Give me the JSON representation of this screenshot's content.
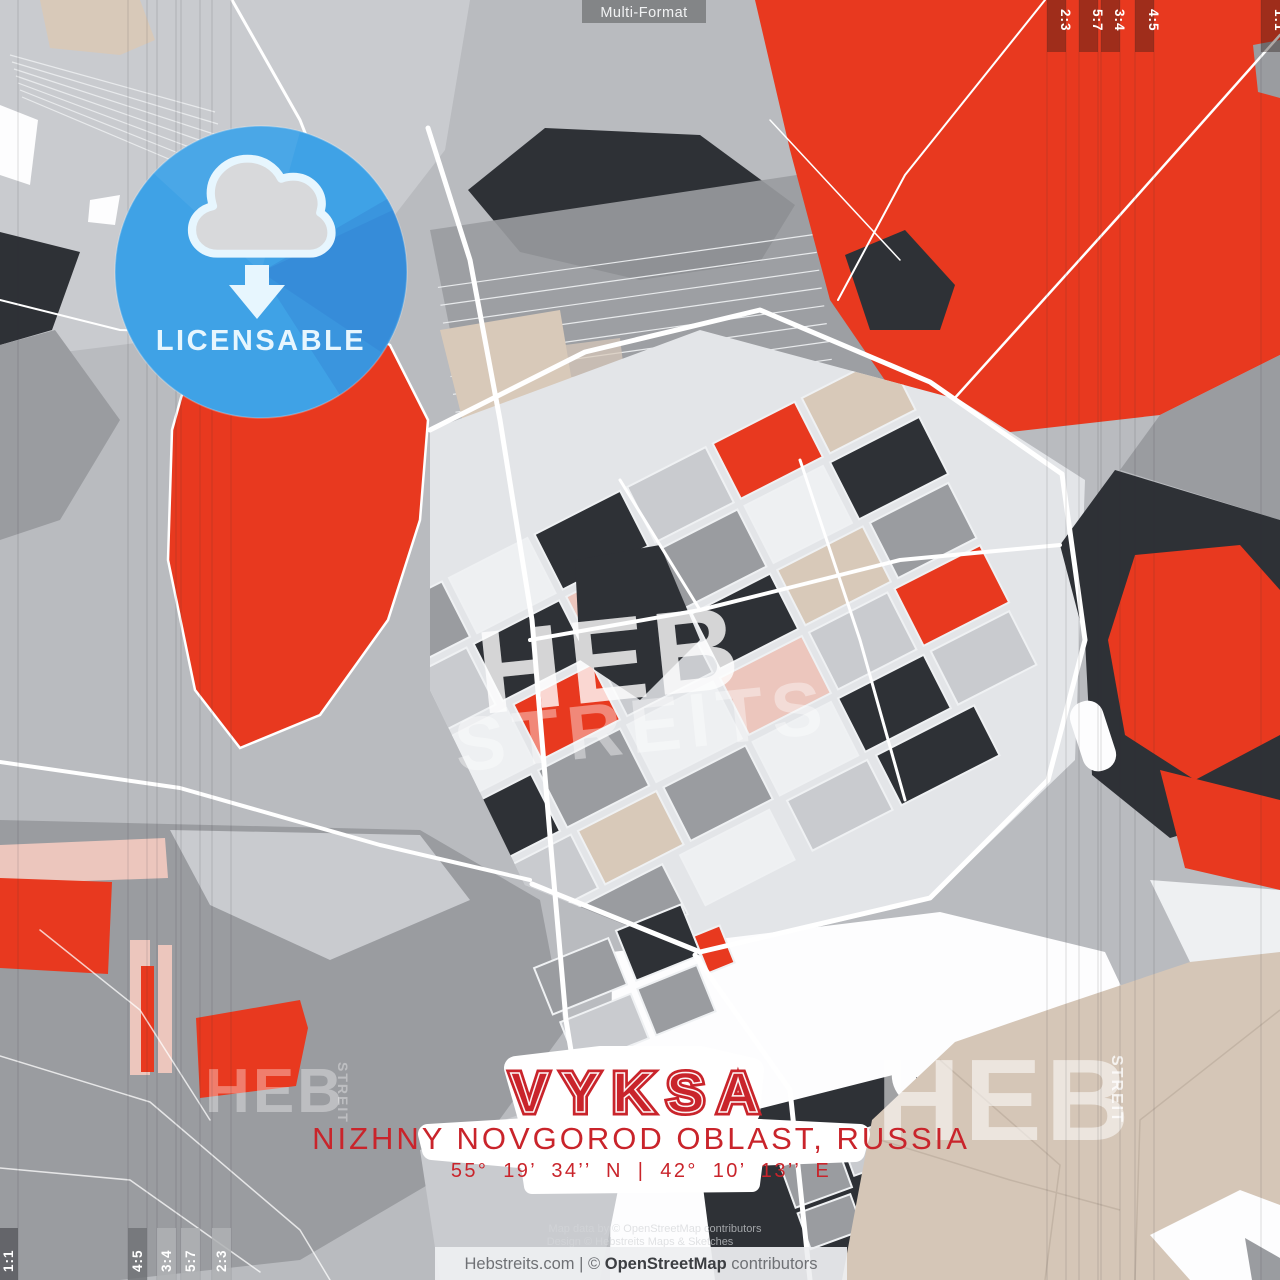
{
  "top_bar": {
    "format_label": "Multi-Format"
  },
  "format_strips": {
    "top_right": [
      "2:3",
      "5:7",
      "3:4",
      "4:5",
      "1:1"
    ],
    "bottom_left": [
      "1:1",
      "4:5",
      "3:4",
      "5:7",
      "2:3"
    ]
  },
  "badge": {
    "label": "LICENSABLE",
    "icon": "cloud-download"
  },
  "title_block": {
    "city": "VYKSA",
    "region": "NIZHNY NOVGOROD OBLAST, RUSSIA",
    "coordinates": "55° 19’ 34’’ N | 42° 10’ 13’’ E"
  },
  "credit": {
    "line1": "Map data by © OpenStreetMap contributors",
    "line2": "Design © Hebstreits Maps & Sketches"
  },
  "footer": {
    "prefix": "Hebstreits.com | © ",
    "brand": "OpenStreetMap",
    "suffix": " contributors"
  },
  "watermarks": {
    "heb_center": "HEB",
    "streits_center": "STREITS",
    "heb_bottom_left": "HEB",
    "streits_bottom_left": "STREIT",
    "heb_bottom_right": "HEB",
    "streits_bottom_right": "STREIT"
  },
  "palette": {
    "red": "#e8391f",
    "dark": "#2e3136",
    "mid_gray": "#9a9ca0",
    "base_gray": "#b9bbbf",
    "light_gray": "#c9cbcf",
    "pale_gray": "#e3e5e8",
    "off_white": "#eef0f2",
    "beige": "#d8c9b9",
    "beige_dark": "#d5c6b7",
    "pink": "#ecc6bd",
    "badge_blue": "#3fa2e6",
    "badge_light": "#e7f6fe",
    "title_red": "#c9242b"
  }
}
